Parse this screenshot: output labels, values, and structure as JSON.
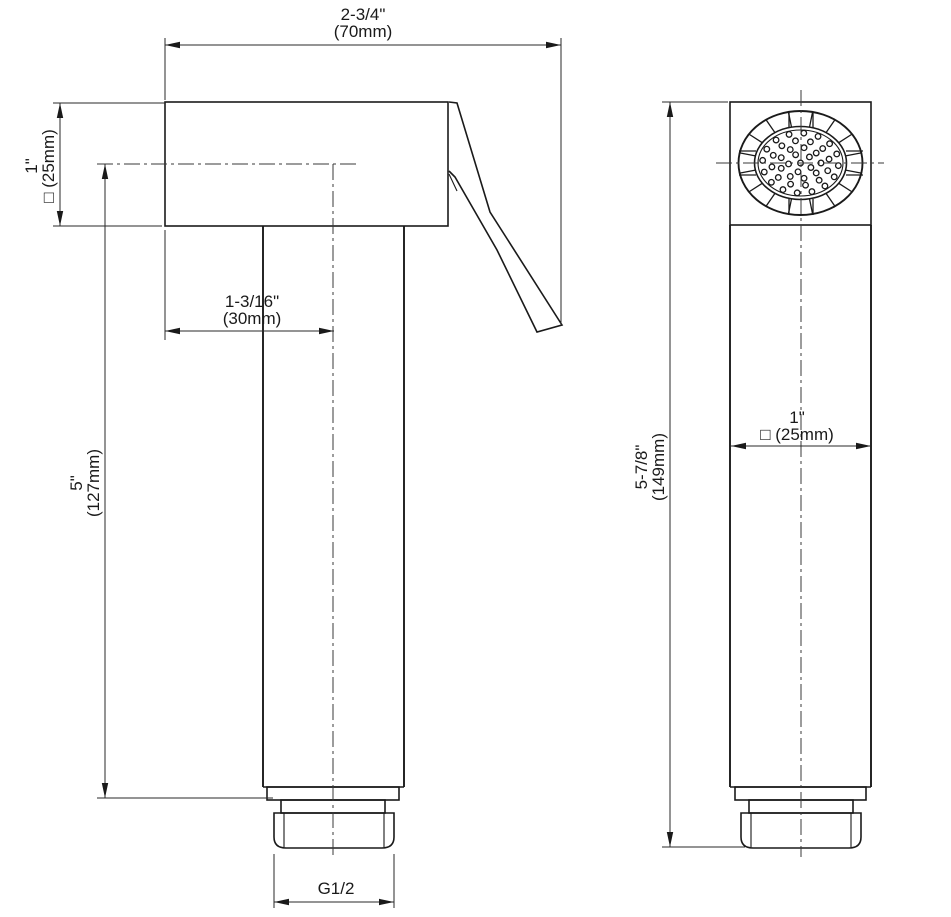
{
  "drawing": {
    "background": "#ffffff",
    "line_color": "#1a1a1a",
    "type": "technical-dimension-drawing",
    "subject": "square hand-held sprayer, side view and front view",
    "labels": {
      "width_top": {
        "imperial": "2-3/4\"",
        "metric": "(70mm)"
      },
      "body_height": {
        "imperial": "1\"",
        "metric": "□ (25mm)"
      },
      "handle_offset": {
        "imperial": "1-3/16\"",
        "metric": "(30mm)"
      },
      "tube_length": {
        "imperial": "5\"",
        "metric": "(127mm)"
      },
      "thread": {
        "label": "G1/2"
      },
      "head_width": {
        "imperial": "1\"",
        "metric": "□ (25mm)"
      },
      "overall_height": {
        "imperial": "5-7/8\"",
        "metric": "(149mm)"
      }
    }
  }
}
